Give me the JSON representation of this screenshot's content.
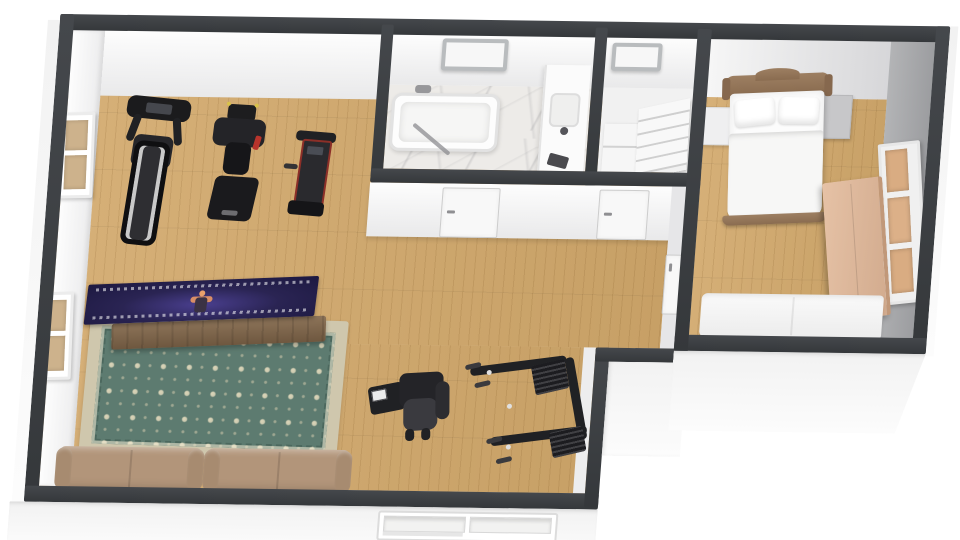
{
  "scene": {
    "type": "3d-floor-plan-render",
    "view": "top-down isometric, slight clockwise tilt",
    "background_color": "#ffffff",
    "visible_text": "none"
  },
  "palette": {
    "wall_cap": "#3a3d41",
    "wall_interior_face": "#f4f4f4",
    "wall_exterior_face": "#fafafa",
    "bedroom_wall_gray": "#a6a7a9",
    "floor_wood": "#cda76f",
    "floor_marble": "#edebe8",
    "rug_field": "#5d7b70",
    "rug_border": "#cfc7ad",
    "sofa_tan": "#b2957a",
    "bed_wood": "#96785c",
    "dresser_wood": "#ddb79c",
    "tv_screen": "#2a2453",
    "gym_equipment": "#202124"
  },
  "rooms": [
    {
      "name": "gym-living-area",
      "floor": "light-oak-plank",
      "furniture": [
        "treadmill",
        "weight-press-machine",
        "incline-trainer",
        "seated-exercise-machine",
        "cable-crossover-machine",
        "flat-tv-on-wood-console",
        "oriental-rug",
        "loveseat-sofa-left",
        "loveseat-sofa-right"
      ],
      "windows": [
        "left-wall-upper",
        "left-wall-lower",
        "bottom-exterior-wall"
      ],
      "tv_screen_content": "performer on dark purple stage surrounded by crowd"
    },
    {
      "name": "bathroom",
      "floor": "white-marble",
      "furniture": [
        "bathtub-with-faucet",
        "glass-shower-screen",
        "vanity-with-sink",
        "dark-accessory"
      ],
      "skylight": true,
      "door_to": "gym-living-area"
    },
    {
      "name": "stair-room",
      "furniture": [
        "staircase-landing",
        "staircase-steps"
      ],
      "skylight": true,
      "door_to": "gym-living-area"
    },
    {
      "name": "bedroom",
      "floor": "light-oak-plank",
      "wall_accent": "gray",
      "furniture": [
        "double-bed-wood-headboard",
        "pillow-left",
        "pillow-right",
        "nightstand-left",
        "nightstand-right",
        "dresser",
        "white-daybed-sofa"
      ],
      "windows": [
        "right-wall-three-pane"
      ],
      "door_to": "hallway"
    }
  ]
}
